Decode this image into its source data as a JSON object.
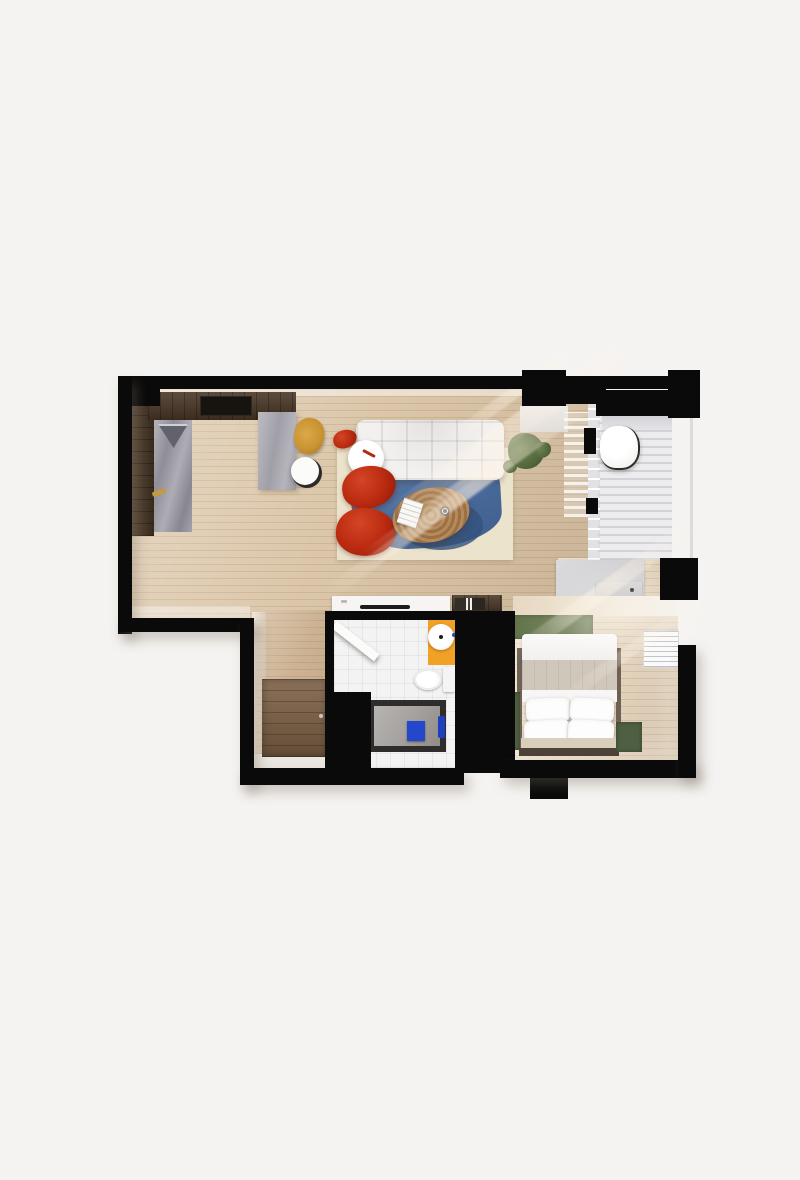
{
  "scene": {
    "type": "apartment-floor-plan-top-down-render",
    "rooms": [
      "living-room",
      "kitchen",
      "balcony",
      "bathroom",
      "bedroom",
      "entry-hallway"
    ],
    "objects": [
      "kitchen-tall-cabinet",
      "kitchen-upper-cabinet",
      "cooktop",
      "corner-sink",
      "kitchen-counter",
      "kitchen-island",
      "yellow-chair",
      "white-stool",
      "tufted-sofa",
      "white-side-table",
      "red-vase",
      "area-rug",
      "red-pouf",
      "red-pouf",
      "rattan-coffee-table",
      "magazine",
      "cup",
      "potted-plant",
      "tv-console",
      "soundbar",
      "appliance-cabinet",
      "sheer-curtain",
      "balcony-glass-wall",
      "balcony-lounge-chair",
      "balcony-slatted-floor",
      "bathroom-door",
      "round-basin",
      "orange-accent-panel",
      "toilet",
      "shower-tray",
      "blue-bath-mat",
      "blue-towel",
      "wardrobe",
      "shoe-bench",
      "bed",
      "duvet",
      "blanket",
      "pillows",
      "bed-bench-green",
      "radiator",
      "entry-door"
    ]
  },
  "palette": {
    "background": "#f5f3f1",
    "wall": "#0a0a0a",
    "floor_wood": "#dcc7aa",
    "floor_wood_dark": "#cdb393",
    "floor_wood_light": "#e7d8c2",
    "cabinet_dark": "#4a3827",
    "counter_marble": "#8f8d97",
    "cooktop": "#17130f",
    "chair_yellow": "#c8932f",
    "sofa_white": "#f3f1ef",
    "rug_cream": "#ece3cc",
    "rug_blue": "#4a6b9c",
    "rug_blue_dark": "#35517d",
    "pouf_red": "#b9290f",
    "pouf_red_dark": "#8a1c08",
    "table_rattan": "#9a7044",
    "plant_green": "#55683d",
    "plant_green_dark": "#3c4f2c",
    "balcony_floor": "#ececee",
    "slat_line": "#d3d3d7",
    "glass": "#e9ebef",
    "bath_floor": "#f3f3f3",
    "accent_orange": "#f2a127",
    "shower_dark": "#2f2d2c",
    "shower_gray": "#a5a2a0",
    "mat_blue": "#2448cc",
    "green_headboard": "#62734c",
    "green_dark": "#4f5f41",
    "blanket_beige": "#cfc7ba",
    "base_beige": "#d9cebc",
    "footboard": "#4d4238",
    "wardrobe_gray": "#c7c7cb",
    "door_wood": "#7c5e43",
    "radiator_line": "#c2c2c6",
    "sun": "rgba(255,244,230,0.95)"
  }
}
